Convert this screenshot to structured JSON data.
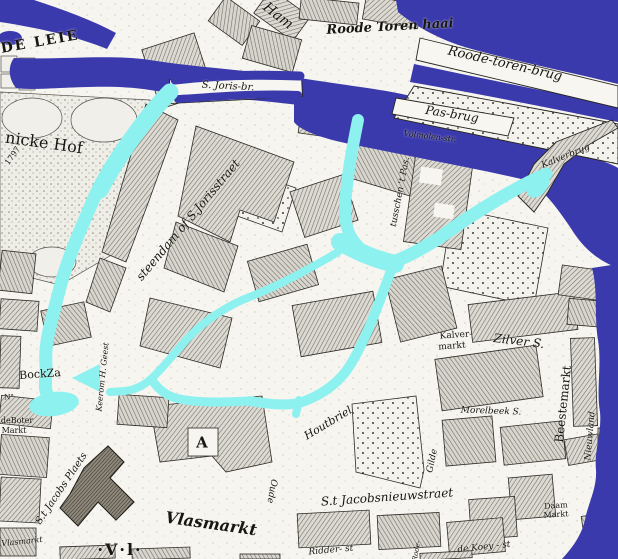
{
  "map": {
    "colors": {
      "paper": "#f6f5f0",
      "river": "#3b3aad",
      "canal": "#8df1ef",
      "ink": "#17160f",
      "block": "#dbd9d1"
    },
    "labels": [
      {
        "id": "de-leie",
        "text": "DE LEIE",
        "x": 40,
        "y": 42,
        "rot": -10,
        "size": 14,
        "cls": "bold-caps"
      },
      {
        "id": "ham",
        "text": "Ham",
        "x": 278,
        "y": 16,
        "rot": 38,
        "size": 14,
        "cls": ""
      },
      {
        "id": "roode-toren-haai",
        "text": "Roode Toren haai",
        "x": 390,
        "y": 27,
        "rot": -3,
        "size": 13,
        "cls": "script"
      },
      {
        "id": "roode-toren-brug",
        "text": "Roode-toren-brug",
        "x": 505,
        "y": 64,
        "rot": 13,
        "size": 13,
        "cls": ""
      },
      {
        "id": "pas-brug",
        "text": "Pas-brug",
        "x": 452,
        "y": 114,
        "rot": 9,
        "size": 12,
        "cls": ""
      },
      {
        "id": "s-joris-br",
        "text": "S. Joris-br.",
        "x": 228,
        "y": 87,
        "rot": 3,
        "size": 10,
        "cls": ""
      },
      {
        "id": "nicke-hof",
        "text": "nicke Hof",
        "x": 44,
        "y": 143,
        "rot": 8,
        "size": 16,
        "cls": "roman"
      },
      {
        "id": "year-1797",
        "text": "1797",
        "x": 13,
        "y": 156,
        "rot": -55,
        "size": 8,
        "cls": "roman"
      },
      {
        "id": "steendam",
        "text": "steendam of S.Jorisstraet",
        "x": 188,
        "y": 220,
        "rot": -50,
        "size": 12,
        "cls": ""
      },
      {
        "id": "tusschen-t-pas",
        "text": "tusschen 't Pas.",
        "x": 401,
        "y": 192,
        "rot": -79,
        "size": 9,
        "cls": ""
      },
      {
        "id": "volmolen-str",
        "text": "Volmolen-str.",
        "x": 430,
        "y": 137,
        "rot": 7,
        "size": 8,
        "cls": ""
      },
      {
        "id": "kalverbrug",
        "text": "Kalverbrug",
        "x": 566,
        "y": 157,
        "rot": -22,
        "size": 9,
        "cls": ""
      },
      {
        "id": "kalver-markt-line1",
        "text": "Kalver-",
        "x": 456,
        "y": 336,
        "rot": -4,
        "size": 9,
        "cls": "roman"
      },
      {
        "id": "kalver-markt-line2",
        "text": "markt",
        "x": 452,
        "y": 347,
        "rot": -4,
        "size": 9,
        "cls": "roman"
      },
      {
        "id": "zilver-st",
        "text": "Zilver S.",
        "x": 519,
        "y": 341,
        "rot": 7,
        "size": 12,
        "cls": ""
      },
      {
        "id": "beestemarkt",
        "text": "Beestemarkt",
        "x": 563,
        "y": 404,
        "rot": -84,
        "size": 12,
        "cls": "roman"
      },
      {
        "id": "morelbeek-st",
        "text": "Morelbeek S.",
        "x": 491,
        "y": 412,
        "rot": 2,
        "size": 9,
        "cls": ""
      },
      {
        "id": "houtbriel",
        "text": "Houtbriel",
        "x": 328,
        "y": 423,
        "rot": -31,
        "size": 11,
        "cls": ""
      },
      {
        "id": "oude",
        "text": "Oude",
        "x": 271,
        "y": 491,
        "rot": 100,
        "size": 9,
        "cls": ""
      },
      {
        "id": "st-jacobsnieuwstraet",
        "text": "S.t Jacobsnieuwstraet",
        "x": 387,
        "y": 497,
        "rot": -4,
        "size": 12,
        "cls": ""
      },
      {
        "id": "gilde",
        "text": "Gilde",
        "x": 433,
        "y": 461,
        "rot": -78,
        "size": 9,
        "cls": ""
      },
      {
        "id": "vlasmarkt",
        "text": "Vlasmarkt",
        "x": 211,
        "y": 524,
        "rot": 8,
        "size": 16,
        "cls": "script"
      },
      {
        "id": "st-jacobs-plaets",
        "text": "S.t Jacobs Plaets",
        "x": 62,
        "y": 489,
        "rot": -56,
        "size": 10,
        "cls": ""
      },
      {
        "id": "block-a",
        "text": "A",
        "x": 203,
        "y": 443,
        "rot": 0,
        "size": 15,
        "cls": "bold-caps"
      },
      {
        "id": "keerom-h-geest",
        "text": "Keerom H. Geest",
        "x": 103,
        "y": 377,
        "rot": -84,
        "size": 8,
        "cls": ""
      },
      {
        "id": "bockza",
        "text": "BockZa",
        "x": 40,
        "y": 374,
        "rot": -4,
        "size": 11,
        "cls": "roman"
      },
      {
        "id": "no-mark",
        "text": "N°",
        "x": 9,
        "y": 398,
        "rot": 0,
        "size": 7,
        "cls": "roman"
      },
      {
        "id": "deboter",
        "text": "deBoter",
        "x": 17,
        "y": 421,
        "rot": 0,
        "size": 8,
        "cls": "roman"
      },
      {
        "id": "deboter-markt",
        "text": "Markt",
        "x": 14,
        "y": 431,
        "rot": 0,
        "size": 8,
        "cls": "roman"
      },
      {
        "id": "koey-st",
        "text": "de Koey - st",
        "x": 484,
        "y": 548,
        "rot": -6,
        "size": 9,
        "cls": ""
      },
      {
        "id": "ridder-st",
        "text": "Ridder- st",
        "x": 331,
        "y": 551,
        "rot": -5,
        "size": 9,
        "cls": ""
      },
      {
        "id": "daam",
        "text": "Daam",
        "x": 556,
        "y": 506,
        "rot": -4,
        "size": 8,
        "cls": "roman"
      },
      {
        "id": "daam-markt",
        "text": "Markt",
        "x": 556,
        "y": 515,
        "rot": -4,
        "size": 8,
        "cls": "roman"
      },
      {
        "id": "nieuwland",
        "text": "Nieuwland",
        "x": 591,
        "y": 436,
        "rot": -85,
        "size": 9,
        "cls": ""
      },
      {
        "id": "vlasmarkt-small",
        "text": "Vlasmarkt",
        "x": 22,
        "y": 542,
        "rot": -6,
        "size": 8,
        "cls": ""
      },
      {
        "id": "rode",
        "text": "Rode-",
        "x": 417,
        "y": 551,
        "rot": -80,
        "size": 7,
        "cls": ""
      },
      {
        "id": "v-l-mark",
        "text": "·V·l·",
        "x": 120,
        "y": 550,
        "rot": 0,
        "size": 16,
        "cls": "bold-caps"
      }
    ]
  }
}
